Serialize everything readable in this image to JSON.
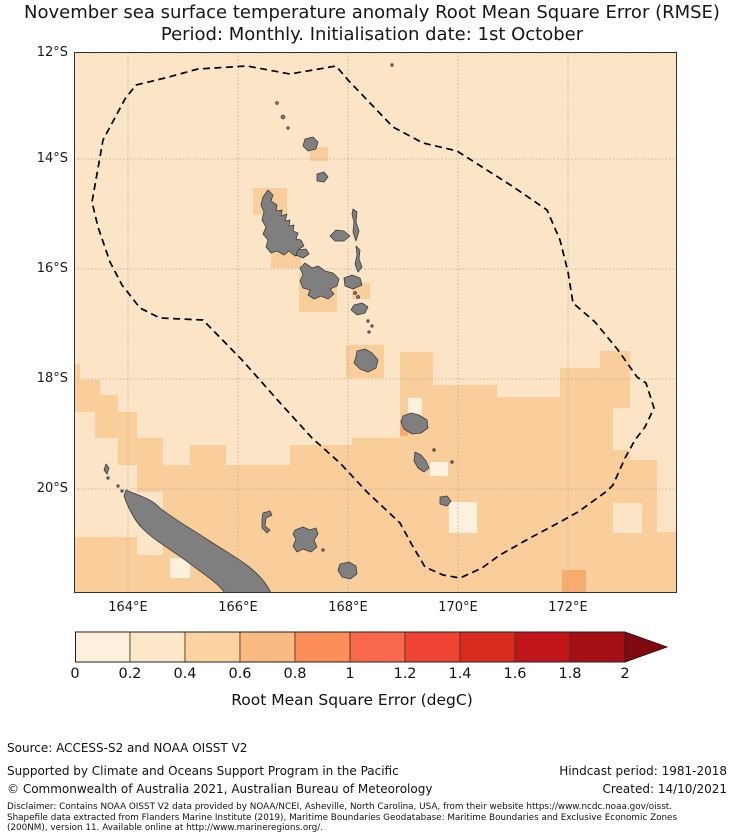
{
  "title": {
    "line1": "November sea surface temperature anomaly Root Mean Square Error (RMSE)",
    "line2": "Period: Monthly. Initialisation date: 1st October"
  },
  "map": {
    "x0": 74,
    "y0": 52,
    "width": 603,
    "height": 541,
    "lat_ticks": [
      {
        "label": "12°S",
        "y": 53
      },
      {
        "label": "14°S",
        "y": 159
      },
      {
        "label": "16°S",
        "y": 269
      },
      {
        "label": "18°S",
        "y": 379
      },
      {
        "label": "20°S",
        "y": 489
      }
    ],
    "lon_ticks": [
      {
        "label": "164°E",
        "x": 128
      },
      {
        "label": "166°E",
        "x": 238
      },
      {
        "label": "168°E",
        "x": 348
      },
      {
        "label": "170°E",
        "x": 458
      },
      {
        "label": "172°E",
        "x": 568
      }
    ],
    "colors": {
      "ocean_base": "#FBE5C6",
      "rmse_low": "#FDF1DE",
      "rmse_mid": "#F9CE9B",
      "rmse_high": "#F6AC6F",
      "land": "#7F7F7F",
      "land_outline": "#3C3C3C",
      "gridline": "#b3ab9b",
      "border": "#333333",
      "eez_line": "#000000"
    },
    "patches": {
      "mid": [
        [
          310,
          147,
          18,
          14
        ],
        [
          253,
          188,
          34,
          27
        ],
        [
          271,
          241,
          30,
          27
        ],
        [
          299,
          274,
          38,
          38
        ],
        [
          352,
          283,
          18,
          16
        ],
        [
          346,
          345,
          38,
          33
        ],
        [
          74,
          364,
          6,
          16
        ],
        [
          74,
          380,
          26,
          16
        ],
        [
          74,
          395,
          44,
          17
        ],
        [
          95,
          412,
          42,
          26
        ],
        [
          118,
          438,
          45,
          27
        ],
        [
          137,
          465,
          53,
          27
        ],
        [
          74,
          537,
          116,
          56
        ],
        [
          163,
          492,
          27,
          101
        ],
        [
          190,
          445,
          36,
          148
        ],
        [
          226,
          465,
          64,
          128
        ],
        [
          290,
          445,
          62,
          148
        ],
        [
          352,
          438,
          48,
          155
        ],
        [
          400,
          352,
          33,
          241
        ],
        [
          433,
          385,
          64,
          208
        ],
        [
          497,
          397,
          63,
          196
        ],
        [
          560,
          368,
          40,
          225
        ],
        [
          600,
          351,
          30,
          242
        ],
        [
          630,
          460,
          27,
          133
        ],
        [
          657,
          532,
          20,
          61
        ]
      ],
      "low_over": [
        [
          74,
          412,
          21,
          80
        ],
        [
          74,
          492,
          44,
          45
        ],
        [
          118,
          492,
          45,
          31
        ],
        [
          137,
          532,
          26,
          23
        ],
        [
          613,
          408,
          44,
          42
        ],
        [
          637,
          377,
          20,
          31
        ],
        [
          613,
          503,
          29,
          30
        ]
      ],
      "lowest": [
        [
          408,
          398,
          14,
          20
        ],
        [
          430,
          462,
          18,
          14
        ],
        [
          449,
          502,
          28,
          31
        ],
        [
          170,
          558,
          20,
          20
        ]
      ],
      "high": [
        [
          400,
          420,
          8,
          16
        ],
        [
          562,
          570,
          24,
          23
        ]
      ]
    },
    "eez_points": "136,85 165,78 198,69 247,66 290,74 336,66 348,80 370,103 393,127 423,143 457,151 512,186 547,210 560,240 568,272 573,303 595,322 618,350 637,377 646,383 654,408 645,427 635,440 625,458 613,485 607,491 578,512 560,522 530,538 500,555 482,568 460,578 443,575 425,567 412,545 400,523 367,492 340,463 312,438 282,405 242,360 203,320 160,318 140,308 122,285 110,262 98,227 92,202 103,140 125,99"
  },
  "colorbar": {
    "title": "Root Mean Square Error (degC)",
    "tick_labels": [
      "0",
      "0.2",
      "0.4",
      "0.6",
      "0.8",
      "1",
      "1.2",
      "1.4",
      "1.6",
      "1.8",
      "2"
    ],
    "tick_values": [
      0,
      0.2,
      0.4,
      0.6,
      0.8,
      1,
      1.2,
      1.4,
      1.6,
      1.8,
      2
    ],
    "segment_colors": [
      "#FDF1DE",
      "#FCE7C9",
      "#FBD3A1",
      "#FBBA81",
      "#FB8F5A",
      "#F8684B",
      "#EF4433",
      "#D92B20",
      "#C0151A",
      "#A50F15"
    ],
    "arrow_color": "#7F0A10",
    "range": [
      0,
      2
    ]
  },
  "chart_data": {
    "type": "heatmap",
    "title": "November sea surface temperature anomaly Root Mean Square Error (RMSE)",
    "subtitle": "Period: Monthly. Initialisation date: 1st October",
    "region": "Vanuatu / New Caledonia EEZ, South Pacific",
    "lon_range_deg_e": [
      163.05,
      173.75
    ],
    "lat_range_deg_s": [
      12.0,
      21.9
    ],
    "value_label": "Root Mean Square Error (degC)",
    "value_range": [
      0,
      2
    ],
    "value_step": 0.2,
    "dominant_values": "mostly 0.2-0.4 north of 18S; 0.4-0.6 south of 18S; isolated 0-0.2 and 0.6-0.8 cells near southern islands"
  },
  "footer": {
    "source": "Source: ACCESS-S2 and NOAA OISST V2",
    "supported": "Supported by Climate and Oceans Support Program in the Pacific",
    "copyright": "© Commonwealth of Australia 2021, Australian Bureau of Meteorology",
    "hindcast": "Hindcast period: 1981-2018",
    "created": "Created: 14/10/2021",
    "disclaimer_lines": [
      "Disclaimer: Contains NOAA OISST V2 data provided by NOAA/NCEI, Asheville, North Carolina, USA, from their website https://www.ncdc.noaa.gov/oisst.",
      "Shapefile data extracted from Flanders Marine Institute (2019), Maritime Boundaries Geodatabase: Maritime Boundaries and Exclusive Economic Zones",
      "(200NM), version 11. Available online at http://www.marineregions.org/."
    ]
  }
}
